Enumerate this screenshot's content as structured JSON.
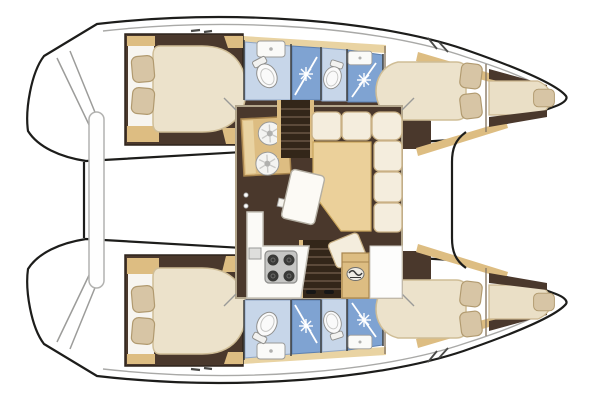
{
  "figure": {
    "kind": "catamaran-interior-floor-plan",
    "orientation": "bow-right-stern-left",
    "hull_count": 2,
    "port_hull_rooms": [
      "aft double cabin",
      "aft head with toilet and sink",
      "aft shower stall",
      "forward head with toilet",
      "forward shower stall with sink",
      "forward double cabin",
      "bow single berth"
    ],
    "starboard_hull_rooms": [
      "aft double cabin",
      "aft head with toilet and sink",
      "aft shower stall",
      "forward head with toilet",
      "forward shower stall with sink",
      "forward double cabin",
      "bow single berth"
    ],
    "saloon_features": [
      "galley unit with twin round sinks",
      "galley counter with four-burner stove and small sink",
      "angled dining table with pedestal",
      "L-shaped settee with tan chaise",
      "port companionway stairs",
      "starboard companionway stairs",
      "aft cabinet with oval brand badge",
      "entry floor panel"
    ],
    "exterior_features": [
      "stern transom steps",
      "aft crossbeam",
      "stowed bench bar",
      "forward crossbeam",
      "side deck lines",
      "deck cleats",
      "chainplate marks"
    ]
  },
  "colors": {
    "outline": "#1d1d1b",
    "deck_line": "#a9a9a7",
    "floor_dark": "#4a382c",
    "stairs_dark": "#332619",
    "wood": "#ddbd82",
    "wood_light": "#e9d3a2",
    "mattress": "#ece2cb",
    "berth": "#eadfc6",
    "pillow": "#d7c5a5",
    "cushion_cream": "#f4eddd",
    "cushion_tan": "#ebd09a",
    "head_blue": "#c7d6e9",
    "shower_blue": "#7fa3d2",
    "counter_white": "#fbfaf7",
    "stove_gray": "#c6c6c4",
    "cabin_floor_white": "#f7f5f0",
    "white": "#fefefe"
  }
}
